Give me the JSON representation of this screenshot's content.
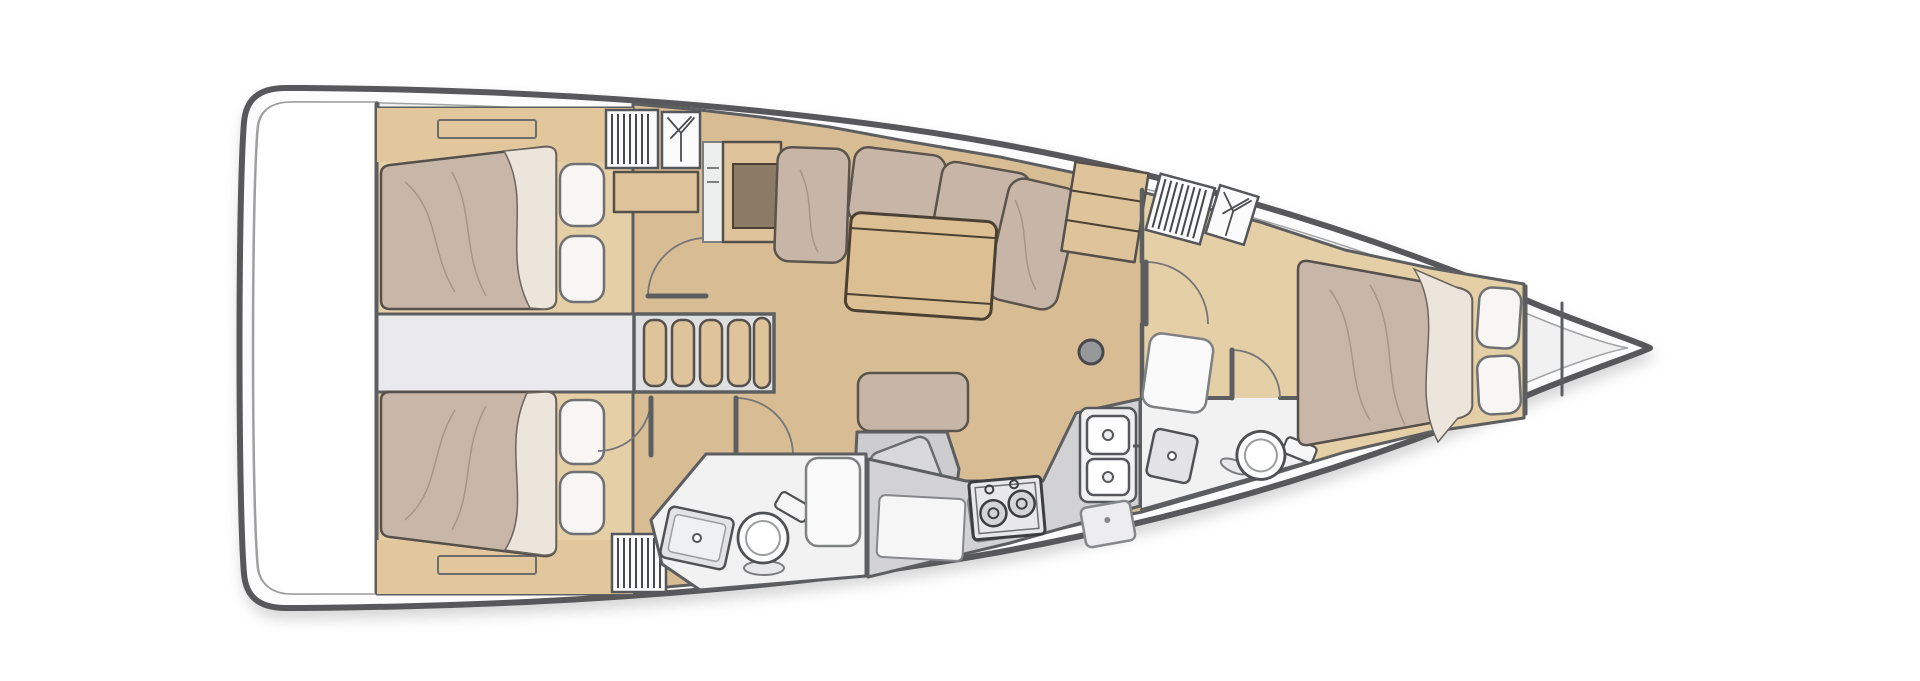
{
  "meta": {
    "type": "floor-plan",
    "subject": "sailing-yacht-interior-layout-top-view",
    "view": "top-down",
    "bow_direction": "right",
    "stern_direction": "left",
    "background": "#ffffff"
  },
  "palette": {
    "hull-outline": "#58585a",
    "deck-white": "#fcfcfd",
    "deck-inner": "#f1f1f2",
    "wall": "#5c5e60",
    "wood-floor": "#d8bd94",
    "wood-light": "#e5cfa6",
    "wood-furniture": "#dfc49b",
    "table-wood": "#dcc094",
    "mattress": "#c8b7a8",
    "blanket": "#ece5db",
    "pillow": "#f7f6f4",
    "cushion": "#c7b6a7",
    "gray-unit": "#cdcdcf",
    "galley-gray": "#d2d2d4",
    "head-floor": "#f2f2f3",
    "fixture": "#fdfdfd",
    "corridor": "#eaeaec",
    "dark-panel": "#8b7a66",
    "mast": "#96989a",
    "louver": "#46484a"
  },
  "boat": {
    "hull": {
      "name": "hull-outline",
      "shape": "sailing-yacht, pointed bow right, rounded transom left"
    },
    "zones": [
      {
        "id": "swim-platform",
        "label": "stern platform / transom"
      },
      {
        "id": "port-aft-cabin",
        "label": "aft cabin (port, top-left)",
        "furniture": [
          "double-berth",
          "blanket-fold",
          "pillow",
          "pillow",
          "headboard-shelf",
          "side-shelf",
          "louvered-locker",
          "hanging-wardrobe",
          "door"
        ]
      },
      {
        "id": "starboard-aft-cabin",
        "label": "aft cabin (starboard, bottom-left)",
        "furniture": [
          "double-berth",
          "blanket-fold",
          "pillow",
          "pillow",
          "footboard-shelf",
          "louvered-locker",
          "door"
        ]
      },
      {
        "id": "engine-compartment",
        "label": "engine compartment passage between aft cabins"
      },
      {
        "id": "companionway",
        "label": "companionway steps",
        "steps": 4
      },
      {
        "id": "salon",
        "label": "salon / saloon",
        "furniture": [
          "settee-cushion",
          "settee-cushion",
          "settee-cushion",
          "settee-cushion",
          "folding-table",
          "chart-cabinet",
          "dark-desk-panel",
          "sliding-panel",
          "storage-cabinet",
          "bench-seat",
          "chart-desk",
          "mast-post"
        ]
      },
      {
        "id": "galley",
        "label": "galley (starboard aft of salon)",
        "stove_burners": 2,
        "sink_basins": 2,
        "furniture": [
          "two-burner-stove",
          "stove-knob",
          "stove-knob",
          "double-sink",
          "faucet",
          "icebox",
          "cabinet-door",
          "cabinet-door"
        ]
      },
      {
        "id": "aft-head",
        "label": "aft head (bathroom)",
        "furniture": [
          "toilet",
          "vanity-sink",
          "shower-pan",
          "door"
        ]
      },
      {
        "id": "forward-head",
        "label": "forward head (bathroom, starboard)",
        "furniture": [
          "toilet",
          "corner-sink",
          "shower-pan",
          "door"
        ]
      },
      {
        "id": "forward-cabin",
        "label": "forward cabin (V-berth)",
        "furniture": [
          "double-berth",
          "blanket-fold",
          "pillow",
          "pillow",
          "louvered-locker",
          "hanging-wardrobe",
          "door"
        ]
      },
      {
        "id": "bow-lockers",
        "label": "bow / anchor locker",
        "bulkheads": 2
      }
    ]
  }
}
